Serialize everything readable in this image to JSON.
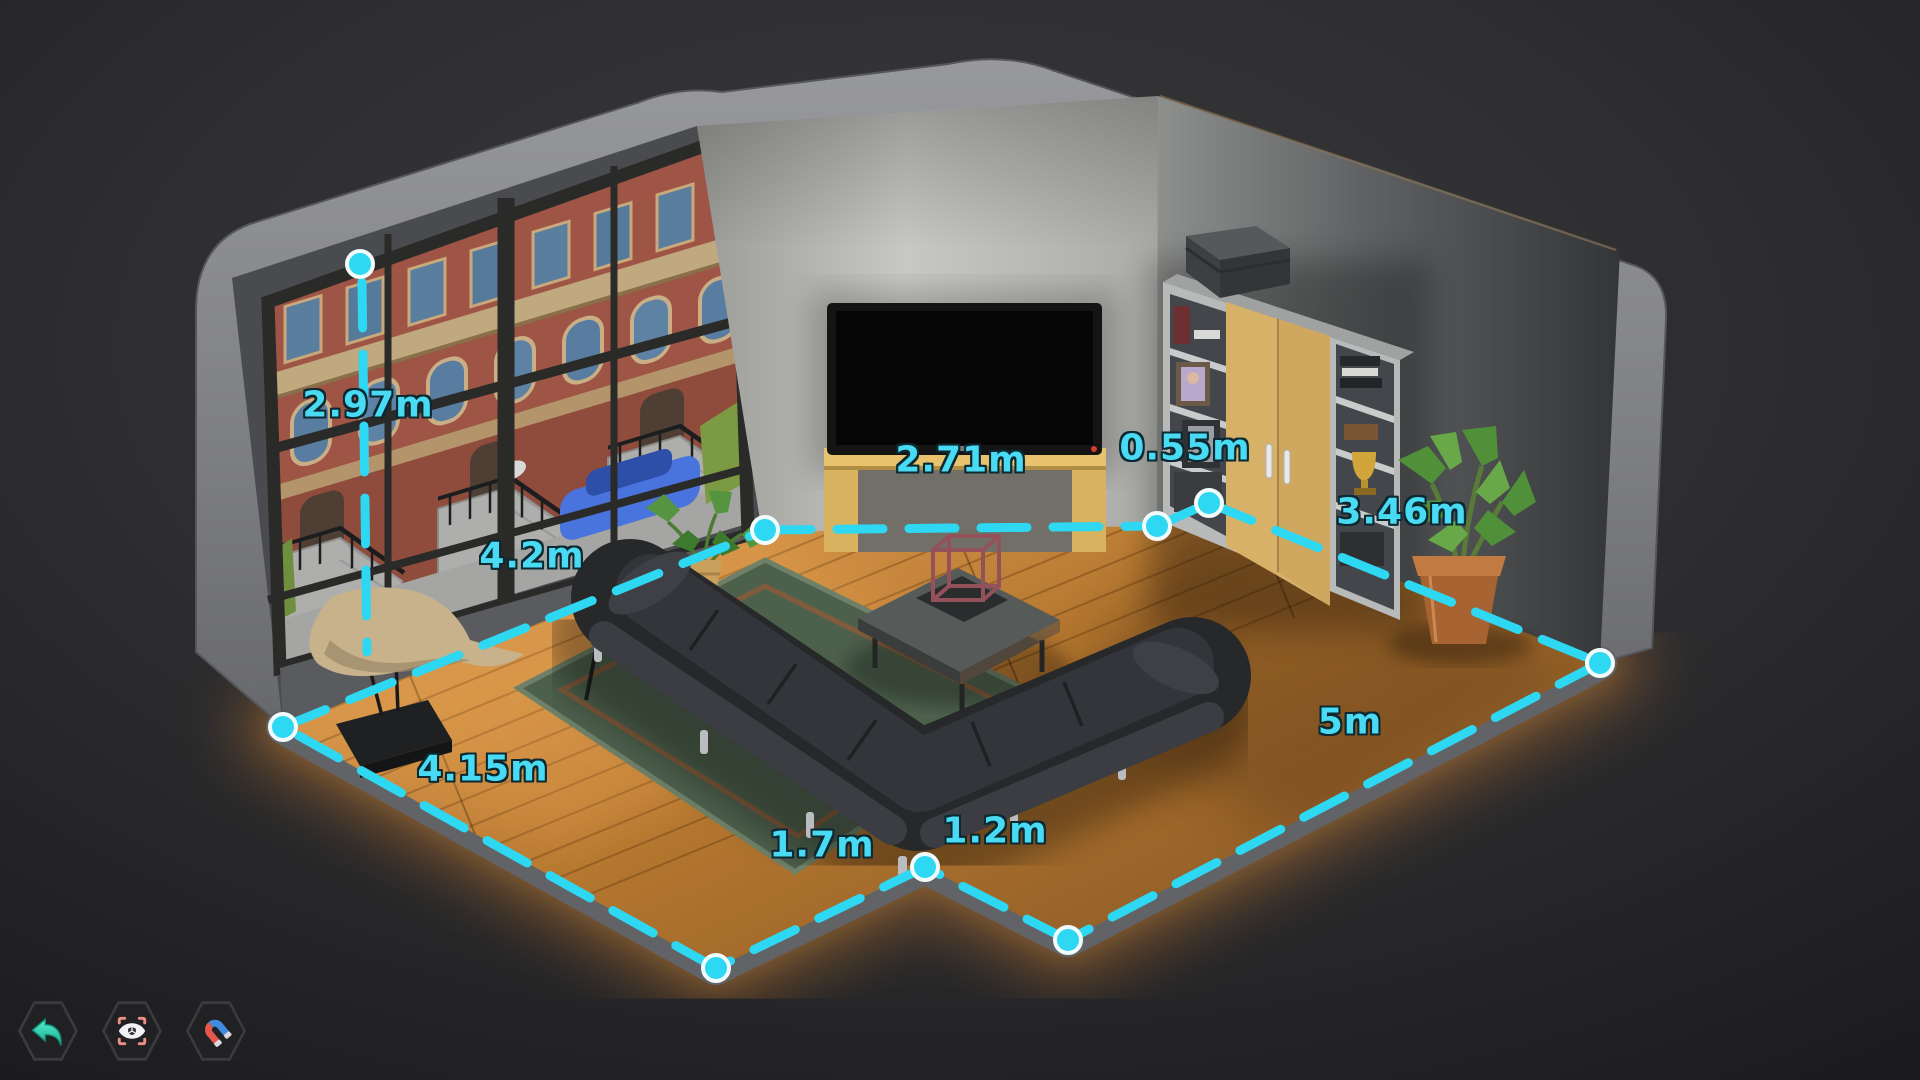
{
  "colors": {
    "accent_cyan": "#2ed7f2",
    "dot_fill": "#2ed7f2",
    "dot_ring": "#f2fbfc",
    "label_text": "#49dbf4",
    "label_outline": "#0c2830",
    "background": "#2a2a2c",
    "shell_gray": "#88898c",
    "floor_wood": "#b5772f",
    "floor_glow": "#c87f35",
    "rug_green": "#4d604c",
    "wardrobe_doors": "#d8b169",
    "tv_stand_yellow": "#d9b25f",
    "undo_icon_teal": "#3fe0c0",
    "scan_brackets_salmon": "#ee8f85",
    "magnet_red": "#e4574b",
    "magnet_blue": "#3f8ce0"
  },
  "measurements": [
    {
      "id": "wall-height",
      "label": "2.97m",
      "value_m": 2.97
    },
    {
      "id": "window-wall-length",
      "label": "4.2m",
      "value_m": 4.2
    },
    {
      "id": "back-wall-length",
      "label": "2.71m",
      "value_m": 2.71
    },
    {
      "id": "wall-recess",
      "label": "0.55m",
      "value_m": 0.55
    },
    {
      "id": "right-wall-length",
      "label": "3.46m",
      "value_m": 3.46
    },
    {
      "id": "front-right-edge",
      "label": "5m",
      "value_m": 5
    },
    {
      "id": "notch-right-edge",
      "label": "1.2m",
      "value_m": 1.2
    },
    {
      "id": "notch-left-edge",
      "label": "1.7m",
      "value_m": 1.7
    },
    {
      "id": "front-left-edge",
      "label": "4.15m",
      "value_m": 4.15
    }
  ],
  "toolbar": {
    "buttons": [
      {
        "name": "undo",
        "icon": "undo-arrow-icon"
      },
      {
        "name": "view-focus",
        "icon": "cube-eye-scan-icon"
      },
      {
        "name": "snap",
        "icon": "magnet-icon"
      }
    ]
  },
  "scene": {
    "objects": [
      "window-wall",
      "city-street-view",
      "tv",
      "tv-stand",
      "wardrobe",
      "bookshelf",
      "storage-box",
      "trophy",
      "floor-plant",
      "rug",
      "sofa-sectional",
      "coffee-table",
      "cube-sculpture",
      "side-table",
      "table-plant",
      "bird-sculpture"
    ]
  }
}
